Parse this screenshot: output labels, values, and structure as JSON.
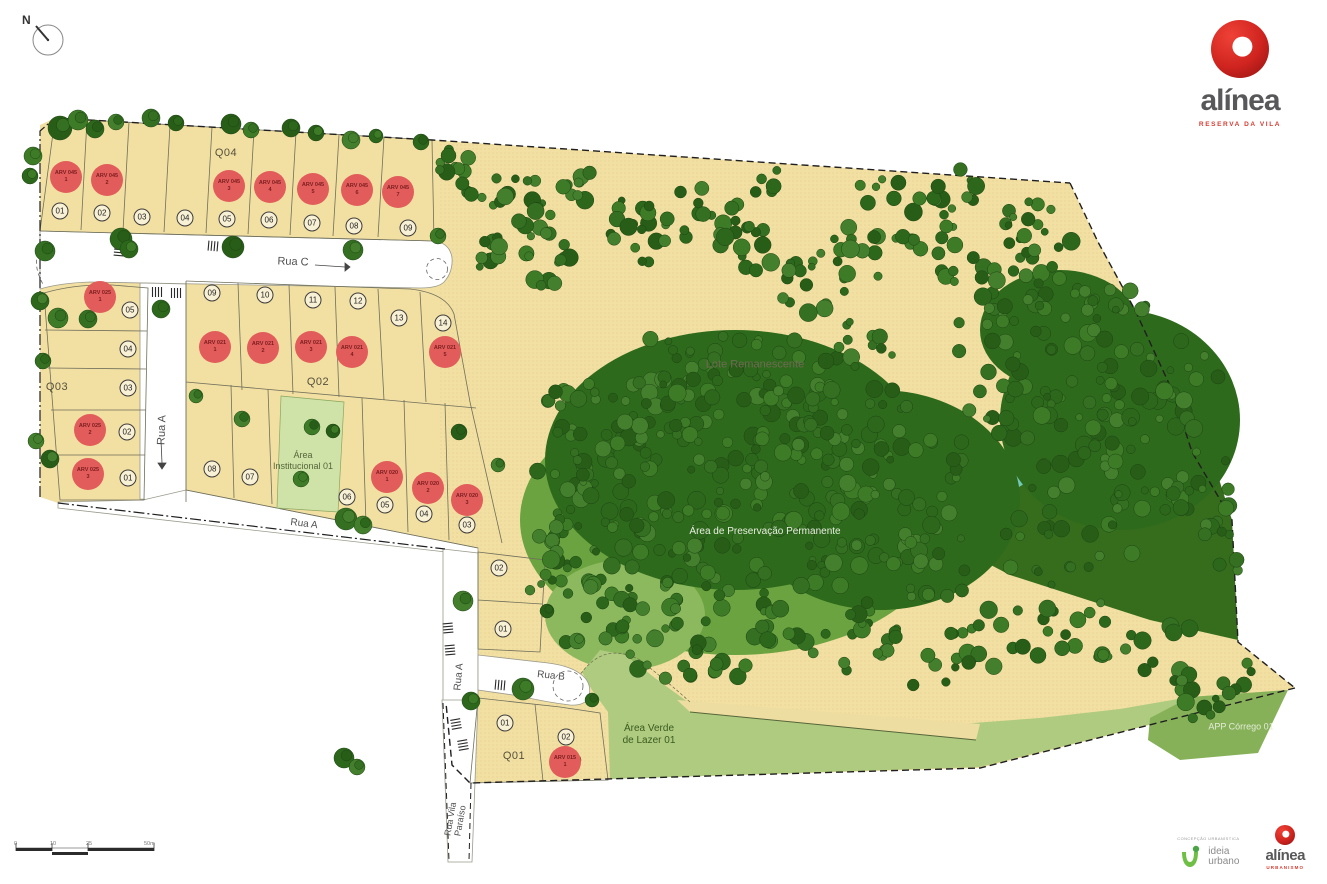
{
  "compass": {
    "label": "N"
  },
  "brand": {
    "name": "alínea",
    "tagline": "RESERVA DA VILA"
  },
  "footer": {
    "partner_caption": "CONCEPÇÃO URBANÍSTICA",
    "partner_name_lines": [
      "ideia",
      "urbano"
    ],
    "brand_name": "alínea",
    "brand_tagline": "URBANISMO"
  },
  "scalebar": {
    "labels": [
      "0",
      "10",
      "25",
      "50m"
    ]
  },
  "palette": {
    "lot_beige": "#f2dfa2",
    "forest_dark": "#2e6a1c",
    "meadow_medium": "#6aa33f",
    "leisure_light": "#aecb7f",
    "app_strip": "#86b159",
    "stream_teal": "#74c9b6",
    "marker_red": "#e25c5c",
    "brand_red": "#d93a30",
    "road_white": "#ffffff"
  },
  "map": {
    "blocks": [
      {
        "label": "Q04",
        "x": 226,
        "y": 153
      },
      {
        "label": "Q03",
        "x": 57,
        "y": 387
      },
      {
        "label": "Q02",
        "x": 318,
        "y": 382
      },
      {
        "label": "Q01",
        "x": 514,
        "y": 756
      }
    ],
    "streets": [
      {
        "label": "Rua C",
        "x": 293,
        "y": 262,
        "rotate": 2,
        "size": 11
      },
      {
        "label": "Rua A",
        "x": 162,
        "y": 430,
        "rotate": -88,
        "size": 11
      },
      {
        "label": "Rua A",
        "x": 304,
        "y": 524,
        "rotate": 7,
        "size": 10
      },
      {
        "label": "Rua A",
        "x": 459,
        "y": 677,
        "rotate": -85,
        "size": 10
      },
      {
        "label": "Rua B",
        "x": 551,
        "y": 676,
        "rotate": 6,
        "size": 10
      },
      {
        "label": "Rua Vila Paraíso",
        "lines": [
          "Rua Vila",
          "Paraíso"
        ],
        "x": 456,
        "y": 820,
        "rotate": -80,
        "size": 9
      }
    ],
    "areas": [
      {
        "lines": [
          "Lote Remanescente"
        ],
        "x": 755,
        "y": 365,
        "color": "#6e6a52",
        "size": 11
      },
      {
        "lines": [
          "Área de Preservação Permanente"
        ],
        "x": 765,
        "y": 532,
        "color": "#e9efe0",
        "size": 10
      },
      {
        "lines": [
          "Área Verde",
          "de Lazer 01"
        ],
        "x": 649,
        "y": 735,
        "color": "#3c5a20",
        "size": 10
      },
      {
        "lines": [
          "APP Córrego 01"
        ],
        "x": 1241,
        "y": 727,
        "color": "#e4ecd8",
        "size": 9
      },
      {
        "lines": [
          "Área",
          "Institucional 01"
        ],
        "x": 303,
        "y": 461,
        "color": "#55663a",
        "size": 9
      }
    ],
    "lot_numbers": [
      {
        "label": "01",
        "x": 60,
        "y": 211
      },
      {
        "label": "02",
        "x": 102,
        "y": 213
      },
      {
        "label": "03",
        "x": 142,
        "y": 217
      },
      {
        "label": "04",
        "x": 185,
        "y": 218
      },
      {
        "label": "05",
        "x": 227,
        "y": 219
      },
      {
        "label": "06",
        "x": 269,
        "y": 220
      },
      {
        "label": "07",
        "x": 312,
        "y": 223
      },
      {
        "label": "08",
        "x": 354,
        "y": 226
      },
      {
        "label": "09",
        "x": 408,
        "y": 228
      },
      {
        "label": "05",
        "x": 130,
        "y": 310
      },
      {
        "label": "04",
        "x": 128,
        "y": 349
      },
      {
        "label": "03",
        "x": 128,
        "y": 388
      },
      {
        "label": "02",
        "x": 127,
        "y": 432
      },
      {
        "label": "01",
        "x": 128,
        "y": 478
      },
      {
        "label": "09",
        "x": 212,
        "y": 293
      },
      {
        "label": "10",
        "x": 265,
        "y": 295
      },
      {
        "label": "11",
        "x": 313,
        "y": 300
      },
      {
        "label": "12",
        "x": 358,
        "y": 301
      },
      {
        "label": "13",
        "x": 399,
        "y": 318
      },
      {
        "label": "14",
        "x": 443,
        "y": 323
      },
      {
        "label": "08",
        "x": 212,
        "y": 469
      },
      {
        "label": "07",
        "x": 250,
        "y": 477
      },
      {
        "label": "06",
        "x": 347,
        "y": 497
      },
      {
        "label": "05",
        "x": 385,
        "y": 505
      },
      {
        "label": "04",
        "x": 424,
        "y": 514
      },
      {
        "label": "03",
        "x": 467,
        "y": 525
      },
      {
        "label": "02",
        "x": 499,
        "y": 568
      },
      {
        "label": "01",
        "x": 503,
        "y": 629
      },
      {
        "label": "01",
        "x": 505,
        "y": 723
      },
      {
        "label": "02",
        "x": 566,
        "y": 737
      }
    ],
    "arv_markers": [
      {
        "code": "ARV 045",
        "num": "1",
        "x": 66,
        "y": 177
      },
      {
        "code": "ARV 045",
        "num": "2",
        "x": 107,
        "y": 180
      },
      {
        "code": "ARV 045",
        "num": "3",
        "x": 229,
        "y": 186
      },
      {
        "code": "ARV 045",
        "num": "4",
        "x": 270,
        "y": 187
      },
      {
        "code": "ARV 045",
        "num": "5",
        "x": 313,
        "y": 189
      },
      {
        "code": "ARV 045",
        "num": "6",
        "x": 357,
        "y": 190
      },
      {
        "code": "ARV 045",
        "num": "7",
        "x": 398,
        "y": 192
      },
      {
        "code": "ARV 025",
        "num": "1",
        "x": 100,
        "y": 297
      },
      {
        "code": "ARV 025",
        "num": "2",
        "x": 90,
        "y": 430
      },
      {
        "code": "ARV 025",
        "num": "3",
        "x": 88,
        "y": 474
      },
      {
        "code": "ARV 021",
        "num": "1",
        "x": 215,
        "y": 347
      },
      {
        "code": "ARV 021",
        "num": "2",
        "x": 263,
        "y": 348
      },
      {
        "code": "ARV 021",
        "num": "3",
        "x": 311,
        "y": 347
      },
      {
        "code": "ARV 021",
        "num": "4",
        "x": 352,
        "y": 352
      },
      {
        "code": "ARV 021",
        "num": "5",
        "x": 445,
        "y": 352
      },
      {
        "code": "ARV 020",
        "num": "1",
        "x": 387,
        "y": 477
      },
      {
        "code": "ARV 020",
        "num": "2",
        "x": 428,
        "y": 488
      },
      {
        "code": "ARV 020",
        "num": "3",
        "x": 467,
        "y": 500
      },
      {
        "code": "ARV 015",
        "num": "1",
        "x": 565,
        "y": 762
      }
    ]
  }
}
